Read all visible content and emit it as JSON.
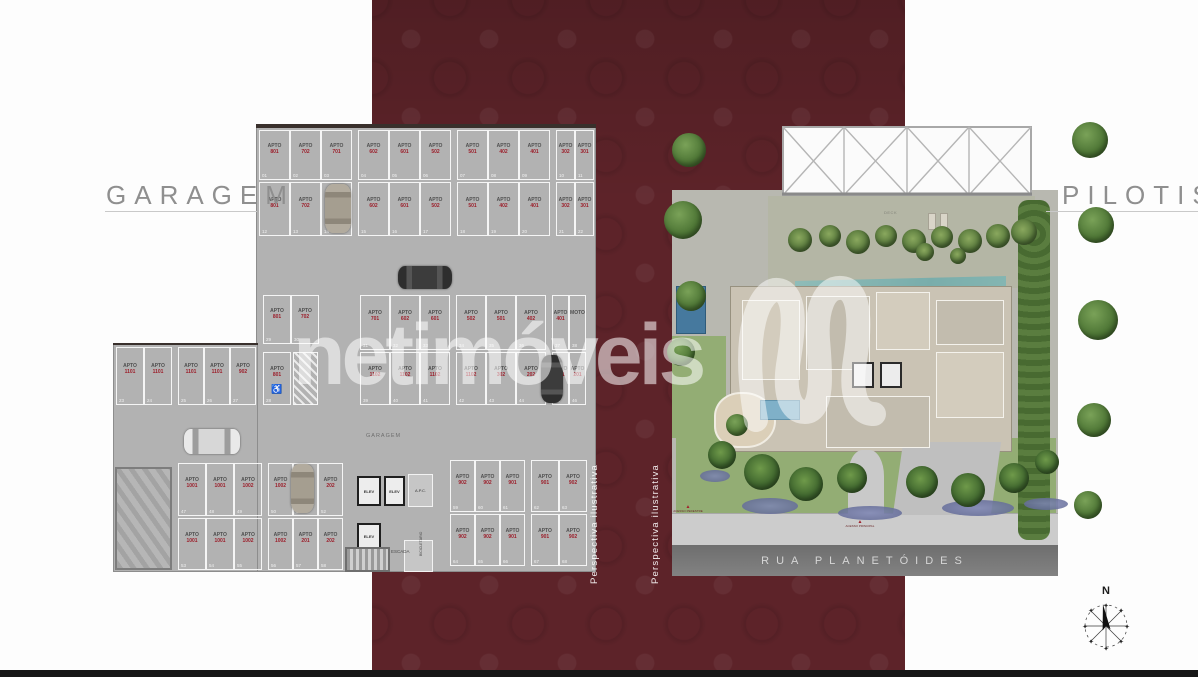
{
  "titles": {
    "garage": "GARAGEM",
    "pilotis": "PILOTIS"
  },
  "watermark": {
    "text": "netimóveis"
  },
  "captions": {
    "p1": "Perspectiva ilustrativa",
    "p2": "Perspectiva ilustrativa"
  },
  "compass": {
    "label": "N"
  },
  "colors": {
    "band": "#5d2329",
    "plan_gray": "#b2b2b2",
    "stall_number_red": "#9c1f2b",
    "pool_teal": "#86b7b3"
  },
  "garage": {
    "inner_label": "GARAGEM",
    "accessible_symbol": "♿",
    "core": {
      "elev": "ELEV",
      "apc": "A.P.C.",
      "escada": "ESCADA",
      "bike": "BICICLETÁRIO"
    },
    "rows": {
      "top1": {
        "labels": [
          "APTO 801",
          "APTO 702",
          "APTO 701",
          "APTO 602",
          "APTO 601",
          "APTO 502",
          "APTO 501",
          "APTO 402",
          "APTO 401",
          "APTO 302",
          "APTO 301"
        ],
        "nums": [
          "01",
          "02",
          "03",
          "04",
          "05",
          "06",
          "07",
          "08",
          "09",
          "10",
          "11"
        ]
      },
      "top2": {
        "labels": [
          "APTO 801",
          "APTO 702",
          "APTO 701",
          "APTO 602",
          "APTO 601",
          "APTO 502",
          "APTO 501",
          "APTO 402",
          "APTO 401",
          "APTO 302",
          "APTO 301"
        ],
        "nums": [
          "12",
          "13",
          "14",
          "15",
          "16",
          "17",
          "18",
          "19",
          "20",
          "21",
          "22"
        ]
      },
      "wing": {
        "labels": [
          "APTO 1101",
          "APTO 1101",
          "APTO 1101",
          "APTO 1101",
          "APTO 902"
        ],
        "nums": [
          "23",
          "24",
          "25",
          "26",
          "27"
        ]
      },
      "acc": {
        "labels": [
          "APTO 801"
        ],
        "nums": [
          "28"
        ]
      },
      "mid_pair": {
        "labels": [
          "APTO 801",
          "APTO 702"
        ],
        "nums": [
          "29",
          "30"
        ]
      },
      "row_c": {
        "labels": [
          "APTO 701",
          "APTO 602",
          "APTO 601",
          "APTO 502",
          "APTO 501",
          "APTO 402",
          "APTO 401",
          "MOTO"
        ],
        "nums": [
          "31",
          "32",
          "33",
          "34",
          "35",
          "36",
          "37",
          "38"
        ]
      },
      "row_d": {
        "labels": [
          "APTO 1102",
          "APTO 1102",
          "APTO 1102",
          "APTO 1102",
          "APTO 302",
          "APTO 202",
          "APTO 201",
          "APTO 201"
        ],
        "nums": [
          "39",
          "40",
          "41",
          "42",
          "43",
          "44",
          "45",
          "46"
        ]
      },
      "row_f": {
        "labels": [
          "APTO 1001",
          "APTO 1001",
          "APTO 1002",
          "APTO 1002",
          "APTO 201",
          "APTO 202"
        ],
        "nums": [
          "47",
          "48",
          "49",
          "50",
          "51",
          "52"
        ]
      },
      "row_g": {
        "labels": [
          "APTO 1001",
          "APTO 1001",
          "APTO 1002",
          "APTO 1002",
          "APTO 201",
          "APTO 202"
        ],
        "nums": [
          "53",
          "54",
          "55",
          "56",
          "57",
          "58"
        ]
      },
      "row_h": {
        "labels": [
          "APTO 902",
          "APTO 902",
          "APTO 901",
          "APTO 901",
          "APTO 902"
        ],
        "nums": [
          "59",
          "60",
          "61",
          "62",
          "63"
        ]
      },
      "row_i": {
        "labels": [
          "APTO 902",
          "APTO 902",
          "APTO 901",
          "APTO 901",
          "APTO 902"
        ],
        "nums": [
          "64",
          "65",
          "66",
          "67",
          "68"
        ]
      }
    }
  },
  "pilotis": {
    "street": "RUA PLANETÓIDES",
    "pool": "PISCINA",
    "deck": "DECK",
    "access_pedestre": "ACESSO PEDESTRE",
    "access_principal": "ACESSO PRINCIPAL"
  }
}
